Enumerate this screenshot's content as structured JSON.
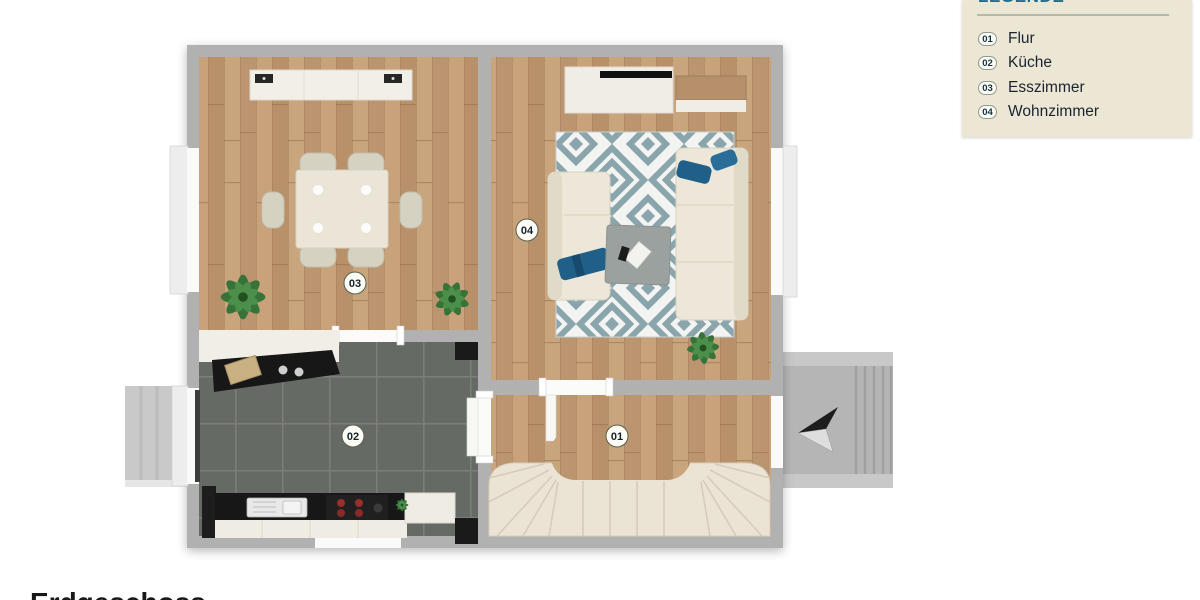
{
  "page": {
    "title": "Erdgeschoss"
  },
  "legend": {
    "title": "LEGENDE",
    "items": [
      {
        "number": "01",
        "label": "Flur"
      },
      {
        "number": "02",
        "label": "Küche"
      },
      {
        "number": "03",
        "label": "Esszimmer"
      },
      {
        "number": "04",
        "label": "Wohnzimmer"
      }
    ],
    "colors": {
      "panel_bg": "#ece6d4",
      "title": "#1b6d94",
      "rule": "#a9b2a0",
      "text": "#1a2430",
      "badge_bg": "#fbfbf6",
      "badge_border": "#8f9b8d"
    }
  },
  "floorplan": {
    "rooms": [
      {
        "number": "01",
        "name": "Flur"
      },
      {
        "number": "02",
        "name": "Küche"
      },
      {
        "number": "03",
        "name": "Esszimmer"
      },
      {
        "number": "04",
        "name": "Wohnzimmer"
      }
    ],
    "colors": {
      "wall": "#b1b1b1",
      "wood_floor": "#c09a72",
      "kitchen_floor": "#666a64",
      "rug_teal": "#8ba5ad",
      "rug_base": "#f3f4f1",
      "stairs": "#ebe3d4",
      "sofa": "#ece7d9",
      "pillow_blue": "#1f5f88",
      "counter_black": "#171717",
      "plant_green": "#377338",
      "concrete": "#b5b5b5"
    }
  }
}
